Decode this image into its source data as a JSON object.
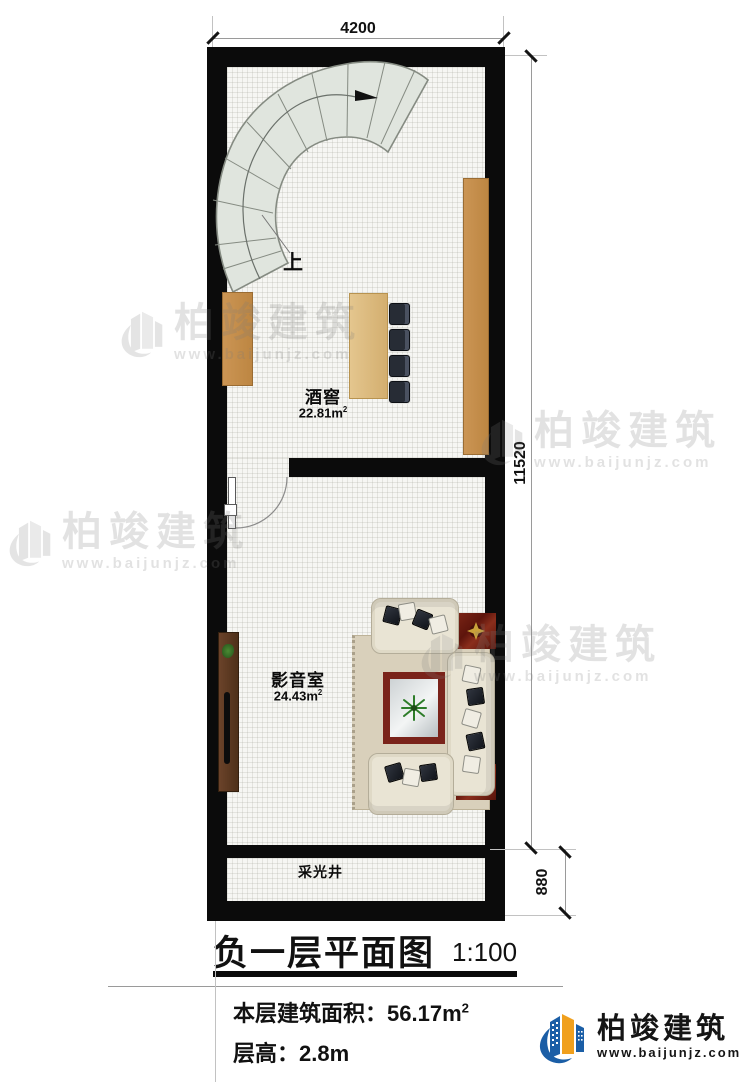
{
  "plan": {
    "dims": {
      "top": "4200",
      "right_main": "11520",
      "right_bottom": "880"
    },
    "stair": {
      "direction_label": "上"
    },
    "rooms": {
      "wine_cellar": {
        "name": "酒窖",
        "area": "22.81m",
        "area_sup": "2"
      },
      "media_room": {
        "name": "影音室",
        "area": "24.43m",
        "area_sup": "2"
      },
      "light_well": {
        "name": "采光井"
      }
    }
  },
  "title_block": {
    "title": "负一层平面图",
    "scale": "1:100",
    "area_label": "本层建筑面积：",
    "area_value": "56.17m",
    "area_sup": "2",
    "floor_height_label": "层高：",
    "floor_height_value": "2.8m"
  },
  "branding": {
    "company": "柏竣建筑",
    "website": "www.baijunjz.com"
  },
  "watermark": {
    "company": "柏竣建筑",
    "website": "www.baijunjz.com"
  },
  "colors": {
    "wall": "#0b0b0b",
    "wood": "#c68f4c",
    "stair": "#e0e5de",
    "sofa": "#e9e4d4",
    "accent_red": "#6e1d12",
    "brand_blue": "#1b5ea6",
    "brand_orange": "#f0a01e"
  }
}
